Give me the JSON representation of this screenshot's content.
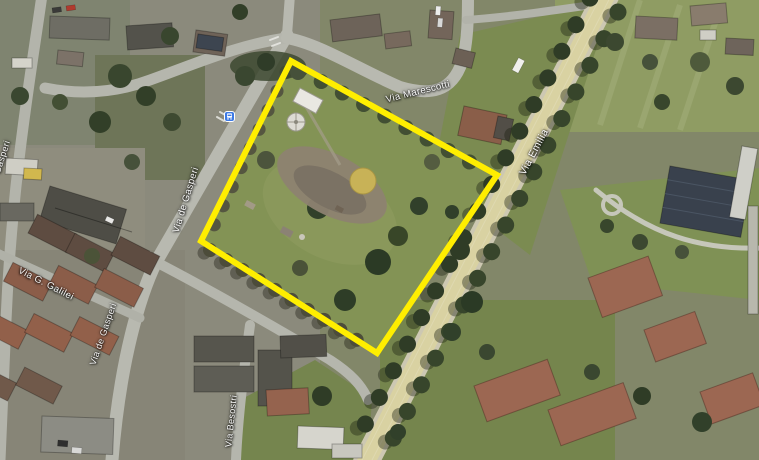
{
  "view": {
    "kind": "satellite-map",
    "description": "Aerial/satellite view of a small town with a park parcel outlined in yellow beside a tree-lined avenue"
  },
  "highlight": {
    "shape": "parcel-outline-quadrilateral",
    "points": "291,61 497,175 377,353 201,241",
    "color": "#ffee00"
  },
  "streets": {
    "labels": [
      {
        "id": "via-marescotti",
        "text": "Via Marescotti"
      },
      {
        "id": "via-emilia",
        "text": "Via Emilia"
      },
      {
        "id": "via-de-gasperi-upper",
        "text": "Via de Gasperi"
      },
      {
        "id": "via-de-gasperi-lower",
        "text": "Via de Gasperi"
      },
      {
        "id": "via-g-galilei",
        "text": "Via G. Galilei"
      },
      {
        "id": "via-besostri",
        "text": "Via Besostri"
      },
      {
        "id": "edge-partial-label",
        "text": "Gasperi"
      }
    ]
  },
  "markers": {
    "bus_stop": {
      "name": "bus-stop-icon",
      "color": "#3d7ae5"
    }
  },
  "colors": {
    "highlight": "#ffee00",
    "major_road_fill": "#d9d2a2",
    "minor_road_fill": "#b8b9b0",
    "label_text": "#ffffff",
    "park_lawn": "#839355"
  }
}
